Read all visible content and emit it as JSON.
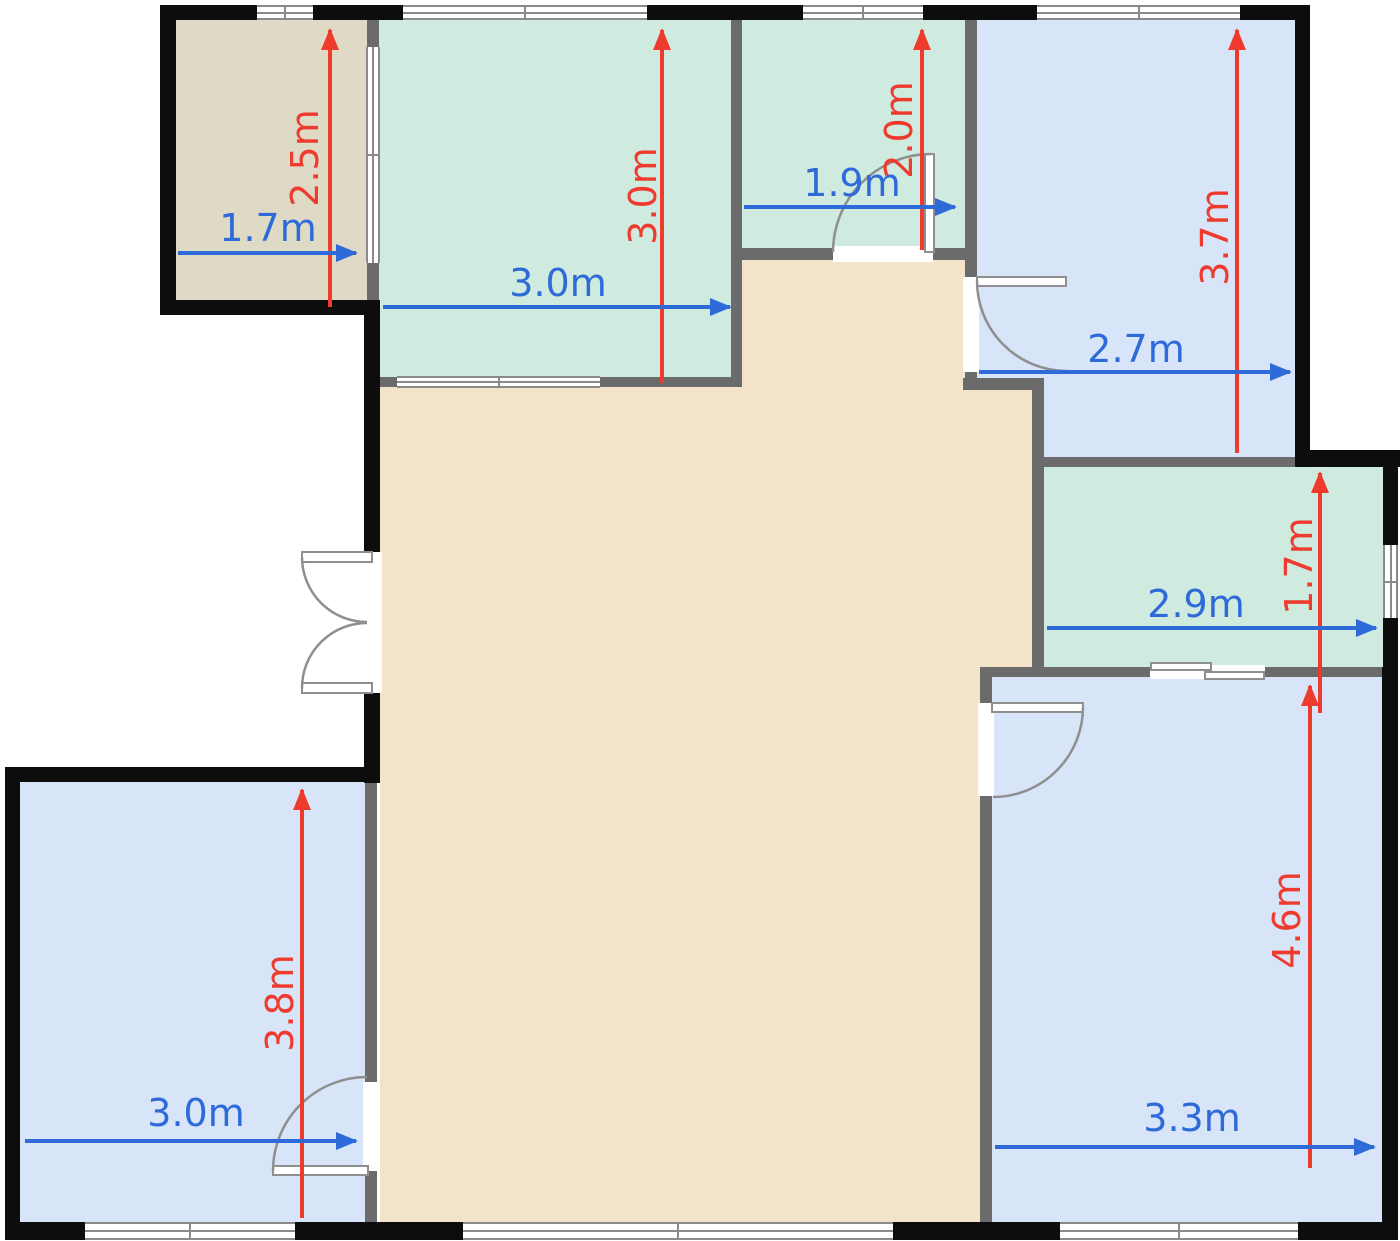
{
  "title": "apartment-floor-plan",
  "colors": {
    "dimension_red": "#ee3b2d",
    "dimension_blue": "#2e6bd9",
    "wall_black": "#0d0d0d",
    "wall_gray": "#6b6b6b",
    "room_mint_green": "#cfeade",
    "room_light_blue": "#d8e5f8",
    "room_beige_living": "#f3e3c9",
    "room_tan_top_left": "#dedac5",
    "window_fill": "#ffffff"
  },
  "dimensions": {
    "top_left_room": {
      "width": "1.7m",
      "height": "2.5m"
    },
    "large_green_room": {
      "width": "3.0m",
      "height": "3.0m"
    },
    "small_green_room": {
      "width": "1.9m",
      "height": "2.0m"
    },
    "top_right_room": {
      "width": "2.7m",
      "height": "3.7m"
    },
    "mid_right_room": {
      "width": "2.9m",
      "height": "1.7m"
    },
    "bottom_right_room": {
      "width": "3.3m",
      "height": "4.6m"
    },
    "bottom_left_room": {
      "width": "3.0m",
      "height": "3.8m"
    }
  }
}
